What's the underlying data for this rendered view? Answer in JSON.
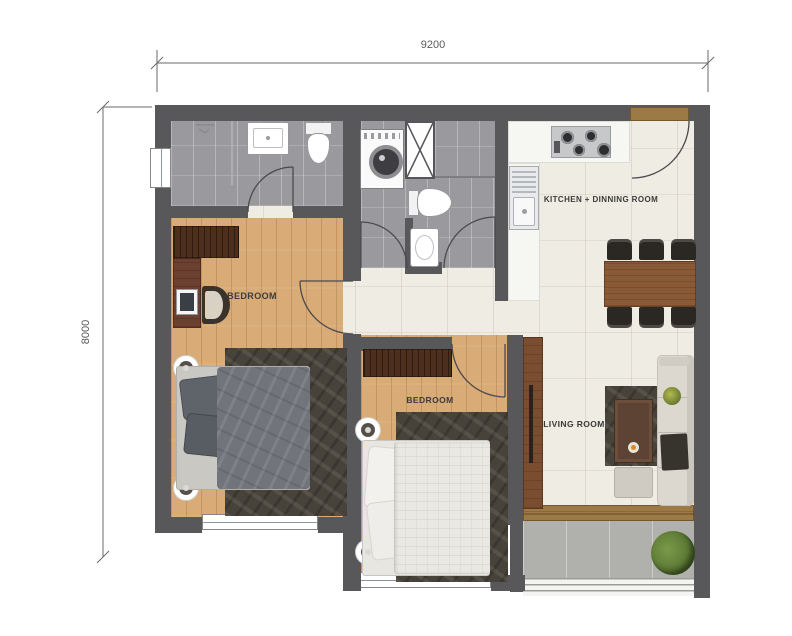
{
  "plan": {
    "title": "apartment-floor-plan",
    "dimensions": {
      "width": "9200",
      "height": "8000"
    },
    "rooms": {
      "bedroom1": "BEDROOM",
      "bedroom2": "BEDROOM",
      "kitchen_dining": "KITCHEN + DINNING ROOM",
      "living_room": "LIVING ROOM"
    }
  },
  "colors": {
    "wall": "#58585a",
    "bath_floor": "#9a9a9e",
    "wood_floor": "#d9ab77",
    "cream_floor": "#efece3",
    "balcony_floor": "#b0b0ac",
    "rug": "#48433a",
    "dark_wood": "#4e2e1c",
    "desk_wood": "#6b4030",
    "table_wood": "#8a5a36",
    "door_wood": "#9c7a45",
    "chair_dark": "#2b2723",
    "sofa": "#dcd8d0",
    "duvet_gray": "#71757b",
    "duvet_white": "#eae8e2",
    "counter": "#f6f6f3",
    "plant": "#5d7a35",
    "dim_text": "#5a5a5a"
  }
}
